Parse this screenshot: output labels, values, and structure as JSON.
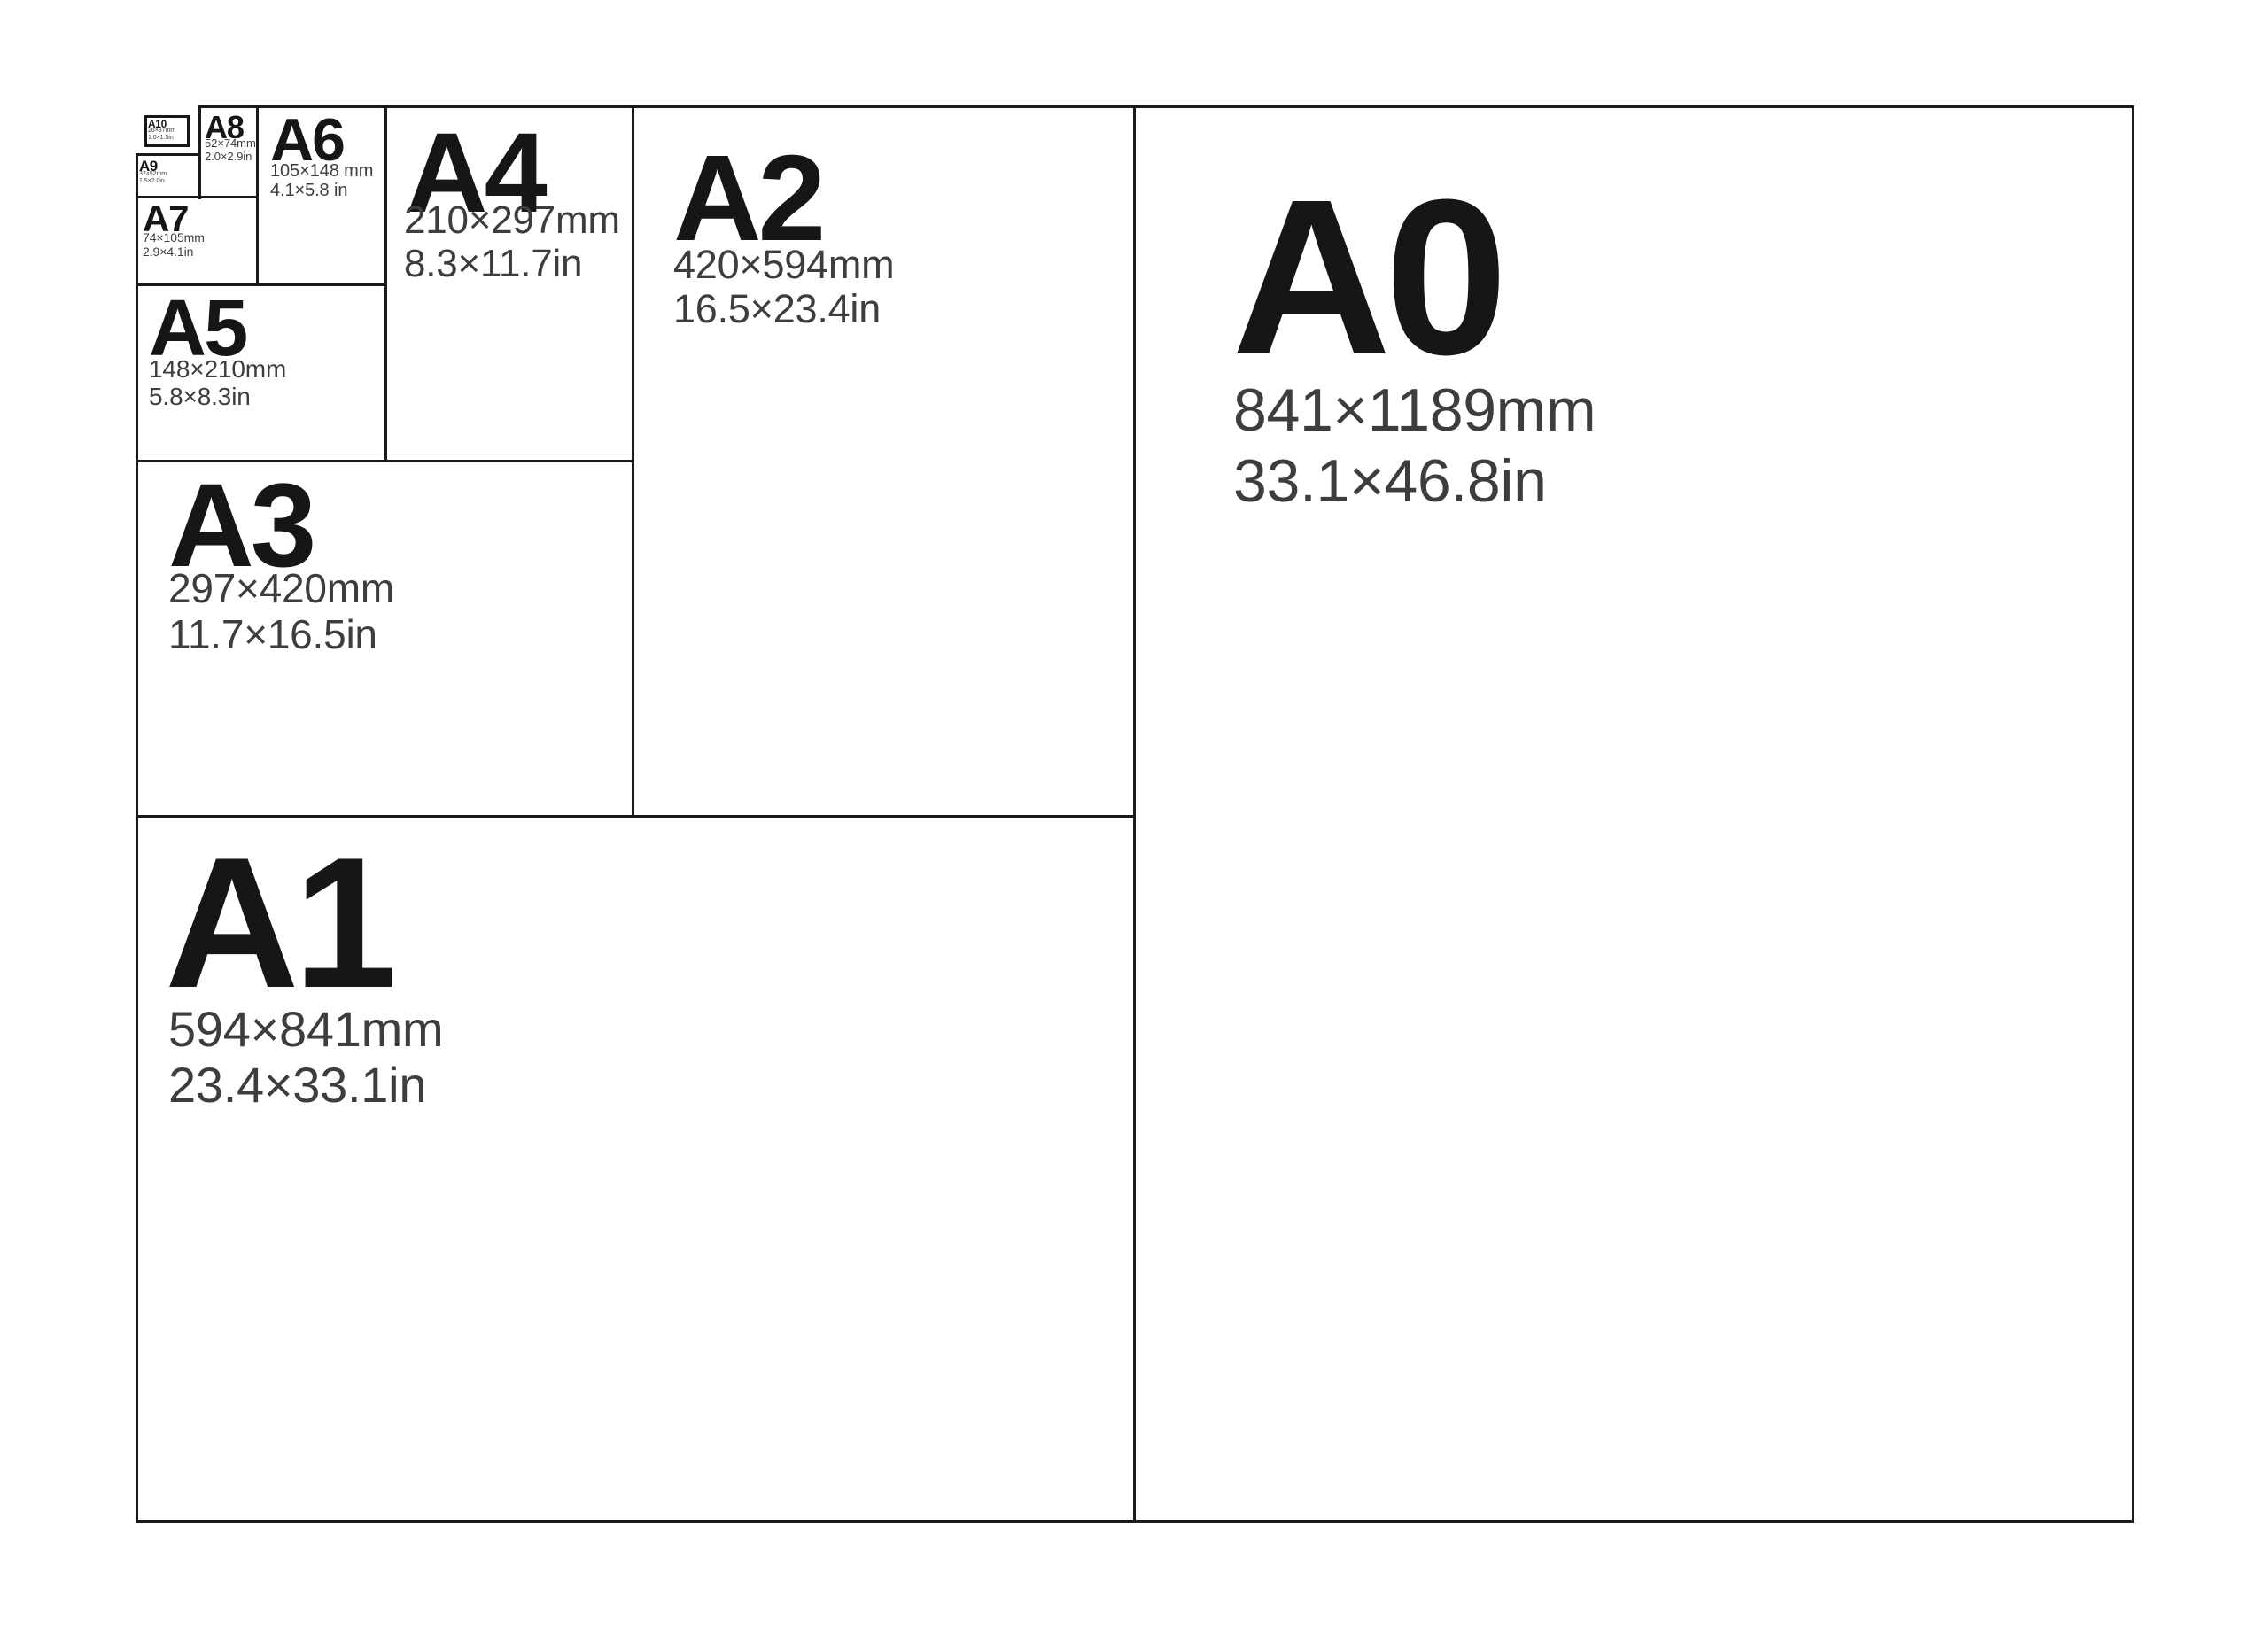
{
  "diagram": {
    "sizes": [
      {
        "name": "A0",
        "mm": "841×1189mm",
        "inches": "33.1×46.8in"
      },
      {
        "name": "A1",
        "mm": "594×841mm",
        "inches": "23.4×33.1in"
      },
      {
        "name": "A2",
        "mm": "420×594mm",
        "inches": "16.5×23.4in"
      },
      {
        "name": "A3",
        "mm": "297×420mm",
        "inches": "11.7×16.5in"
      },
      {
        "name": "A4",
        "mm": "210×297mm",
        "inches": "8.3×11.7in"
      },
      {
        "name": "A5",
        "mm": "148×210mm",
        "inches": "5.8×8.3in"
      },
      {
        "name": "A6",
        "mm": "105×148 mm",
        "inches": "4.1×5.8 in"
      },
      {
        "name": "A7",
        "mm": "74×105mm",
        "inches": "2.9×4.1in"
      },
      {
        "name": "A8",
        "mm": "52×74mm",
        "inches": "2.0×2.9in"
      },
      {
        "name": "A9",
        "mm": "37×52mm",
        "inches": "1.5×2.0in"
      },
      {
        "name": "A10",
        "mm": "26×37mm",
        "inches": "1.0×1.5in"
      }
    ],
    "colors": {
      "background": "#ffffff",
      "line": "#1a1a1a",
      "heading_text": "#161616",
      "dimension_text": "#3d3d3d"
    }
  }
}
